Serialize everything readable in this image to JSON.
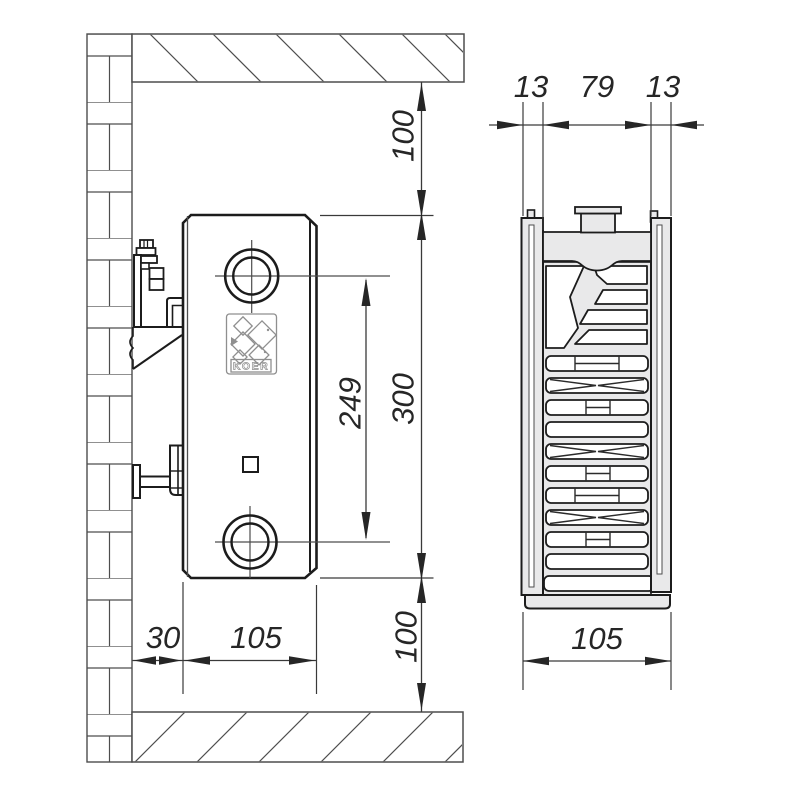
{
  "brand": {
    "logo_text": "KOER"
  },
  "side_view": {
    "dims": {
      "top_clearance": "100",
      "radiator_height": "300",
      "connection_spacing": "249",
      "bottom_clearance": "100",
      "wall_gap": "30",
      "depth": "105"
    }
  },
  "section_view": {
    "dims": {
      "front_panel": "13",
      "core": "79",
      "rear_panel": "13",
      "total_depth": "105"
    }
  }
}
